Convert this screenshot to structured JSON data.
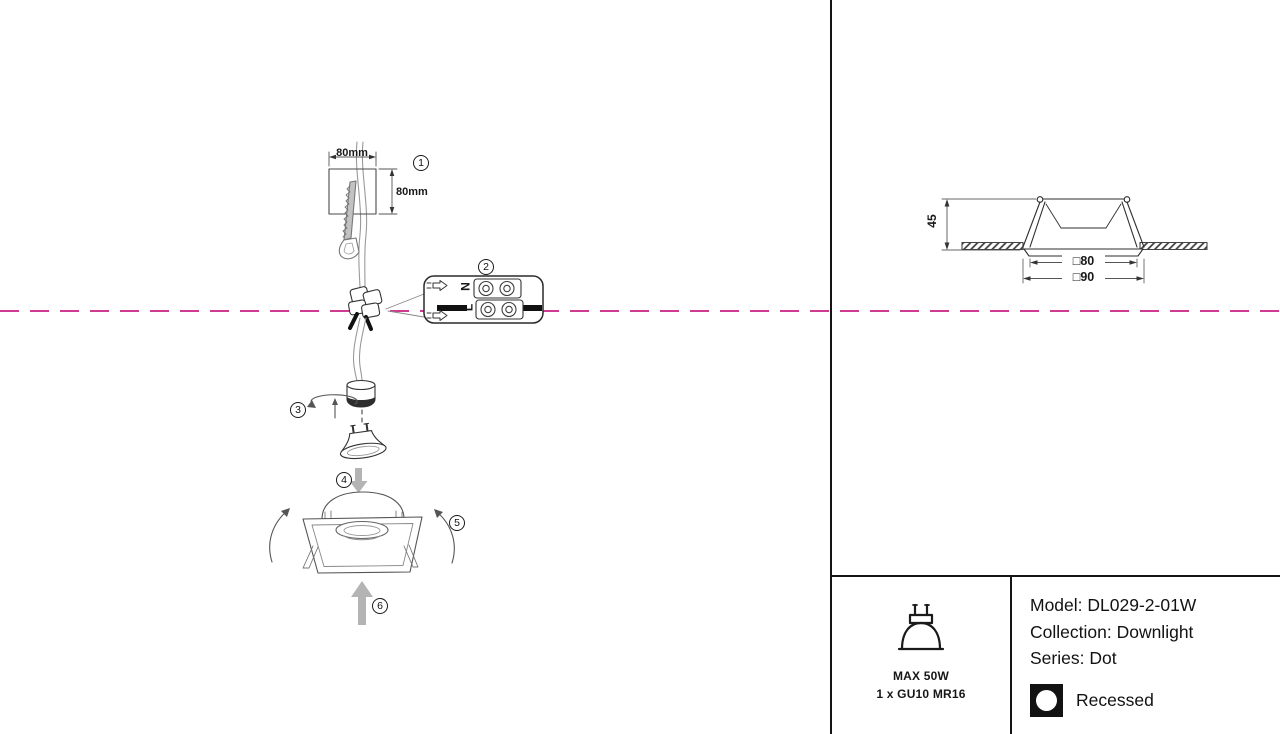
{
  "colors": {
    "dashed_line": "#ce3b90",
    "line_art": "#3f3f3f",
    "panel_border": "#141414"
  },
  "installation_steps": {
    "step1": {
      "number": "1",
      "hole_width": "80mm",
      "hole_height": "80mm"
    },
    "step2": {
      "number": "2",
      "terminal_neutral": "N",
      "terminal_live": "L"
    },
    "step3": {
      "number": "3"
    },
    "step4": {
      "number": "4"
    },
    "step5": {
      "number": "5"
    },
    "step6": {
      "number": "6"
    }
  },
  "section_view": {
    "recess_depth": "45",
    "cutout_size": "□80",
    "trim_size": "□90"
  },
  "spec_panel": {
    "lamp": {
      "max_power": "MAX 50W",
      "lamp_count_type": "1 x GU10 MR16"
    },
    "product": {
      "model": "Model: DL029-2-01W",
      "collection": "Collection: Downlight",
      "series": "Series: Dot",
      "mounting_type": "Recessed"
    }
  }
}
